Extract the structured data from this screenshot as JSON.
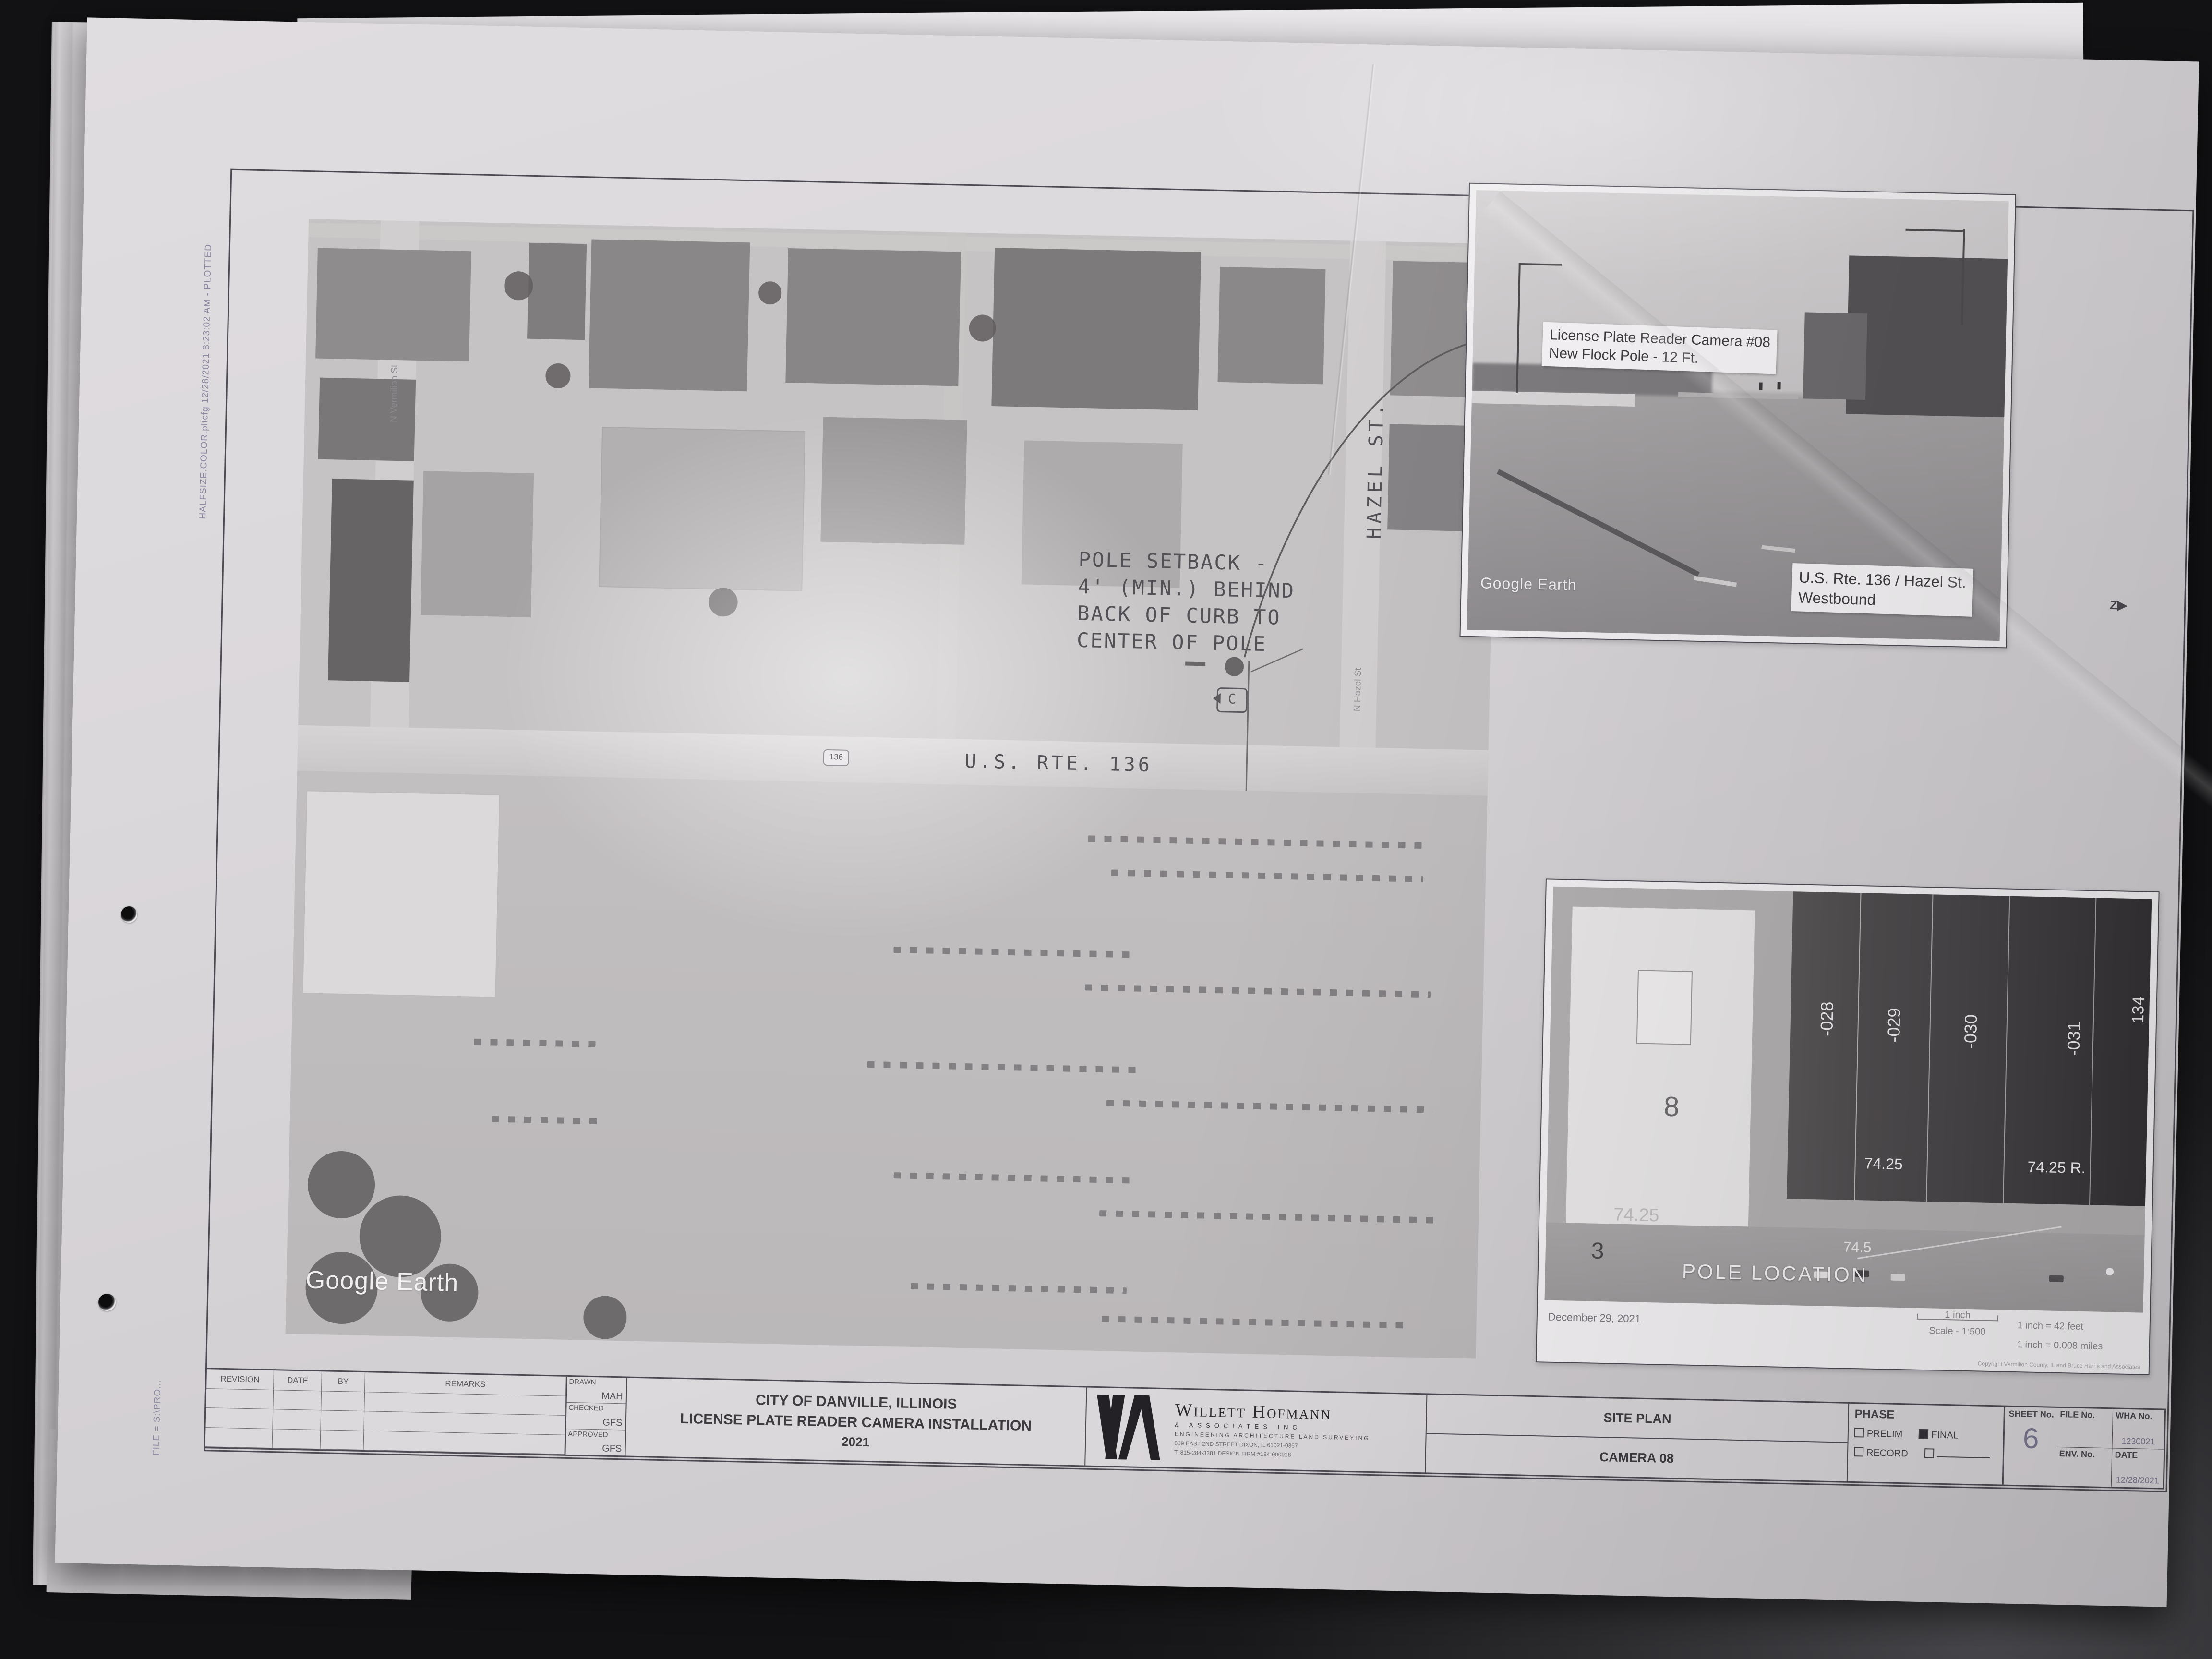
{
  "stamps": {
    "plot_stamp": "HALFSIZE.COLOR.pltcfg  12/28/2021  8:23:02 AM - PLOTTED",
    "file_note": "FILE = S:\\PRO...",
    "z_marker": "Z"
  },
  "main_map": {
    "watermark": "Google Earth",
    "route_shield": "136",
    "road_label": "U.S. RTE. 136",
    "street_label_vertical": "HAZEL ST.",
    "street_label_small": "N Hazel St",
    "street_label_small_2": "N Vermilion St",
    "pole_note_lines": [
      "POLE SETBACK -",
      "4' (MIN.) BEHIND",
      "BACK OF CURB TO",
      "CENTER OF POLE"
    ],
    "camera_symbol": "C"
  },
  "street_view_inset": {
    "camera_label_line1": "License Plate Reader Camera #08",
    "camera_label_line2": "New Flock Pole - 12 Ft.",
    "location_label_line1": "U.S. Rte. 136 / Hazel St.",
    "location_label_line2": "Westbound",
    "watermark": "Google Earth"
  },
  "aerial_inset": {
    "pole_location_label": "POLE LOCATION",
    "parcel_labels": [
      "-028",
      "-029",
      "-030",
      "-031"
    ],
    "parcel_label_right": "134",
    "measurements": [
      "74.25",
      "74.25",
      "74.25 R.",
      "64.25 R",
      "74.5"
    ],
    "lot_number_large": "8",
    "lot_number_large_2": "3",
    "date_caption": "December 29, 2021",
    "scale_bar_label": "1 inch",
    "scale_caption": "Scale - 1:500",
    "scale_feet": "1 inch = 42 feet",
    "scale_miles": "1 inch = 0.008 miles",
    "copyright": "Copyright Vermilion County, IL and Bruce Harris and Associates"
  },
  "title_block": {
    "revision_headers": [
      "REVISION",
      "DATE",
      "BY",
      "REMARKS"
    ],
    "approvals": [
      {
        "label": "DRAWN",
        "value": "MAH"
      },
      {
        "label": "CHECKED",
        "value": "GFS"
      },
      {
        "label": "APPROVED",
        "value": "GFS"
      }
    ],
    "project_title_line1": "CITY OF DANVILLE, ILLINOIS",
    "project_title_line2": "LICENSE PLATE READER CAMERA INSTALLATION",
    "project_title_line3": "2021",
    "firm_name": "Willett Hofmann",
    "firm_sub": "& ASSOCIATES INC",
    "firm_disciplines": "ENGINEERING   ARCHITECTURE   LAND SURVEYING",
    "firm_address": "809 EAST 2ND STREET   DIXON, IL 61021-0367",
    "firm_phone": "T: 815-284-3381   DESIGN FIRM #184-000918",
    "sheet_title": "SITE PLAN",
    "sheet_subtitle": "CAMERA 08",
    "phase": {
      "label": "PHASE",
      "options": [
        {
          "label": "PRELIM",
          "checked": false
        },
        {
          "label": "FINAL",
          "checked": true
        },
        {
          "label": "RECORD",
          "checked": false
        },
        {
          "label": "",
          "checked": false
        }
      ]
    },
    "file_no_label": "FILE No.",
    "file_no_value": "",
    "wha_no_label": "WHA No.",
    "wha_no_value": "1230021",
    "env_no_label": "ENV. No.",
    "env_no_value": "",
    "date_label": "DATE",
    "date_value": "12/28/2021",
    "sheet_no_label": "SHEET No.",
    "sheet_no_value": "6"
  },
  "colors": {
    "desk": "#2c2c2f",
    "paper": "#d8d5d8",
    "ink": "#4c4952"
  }
}
